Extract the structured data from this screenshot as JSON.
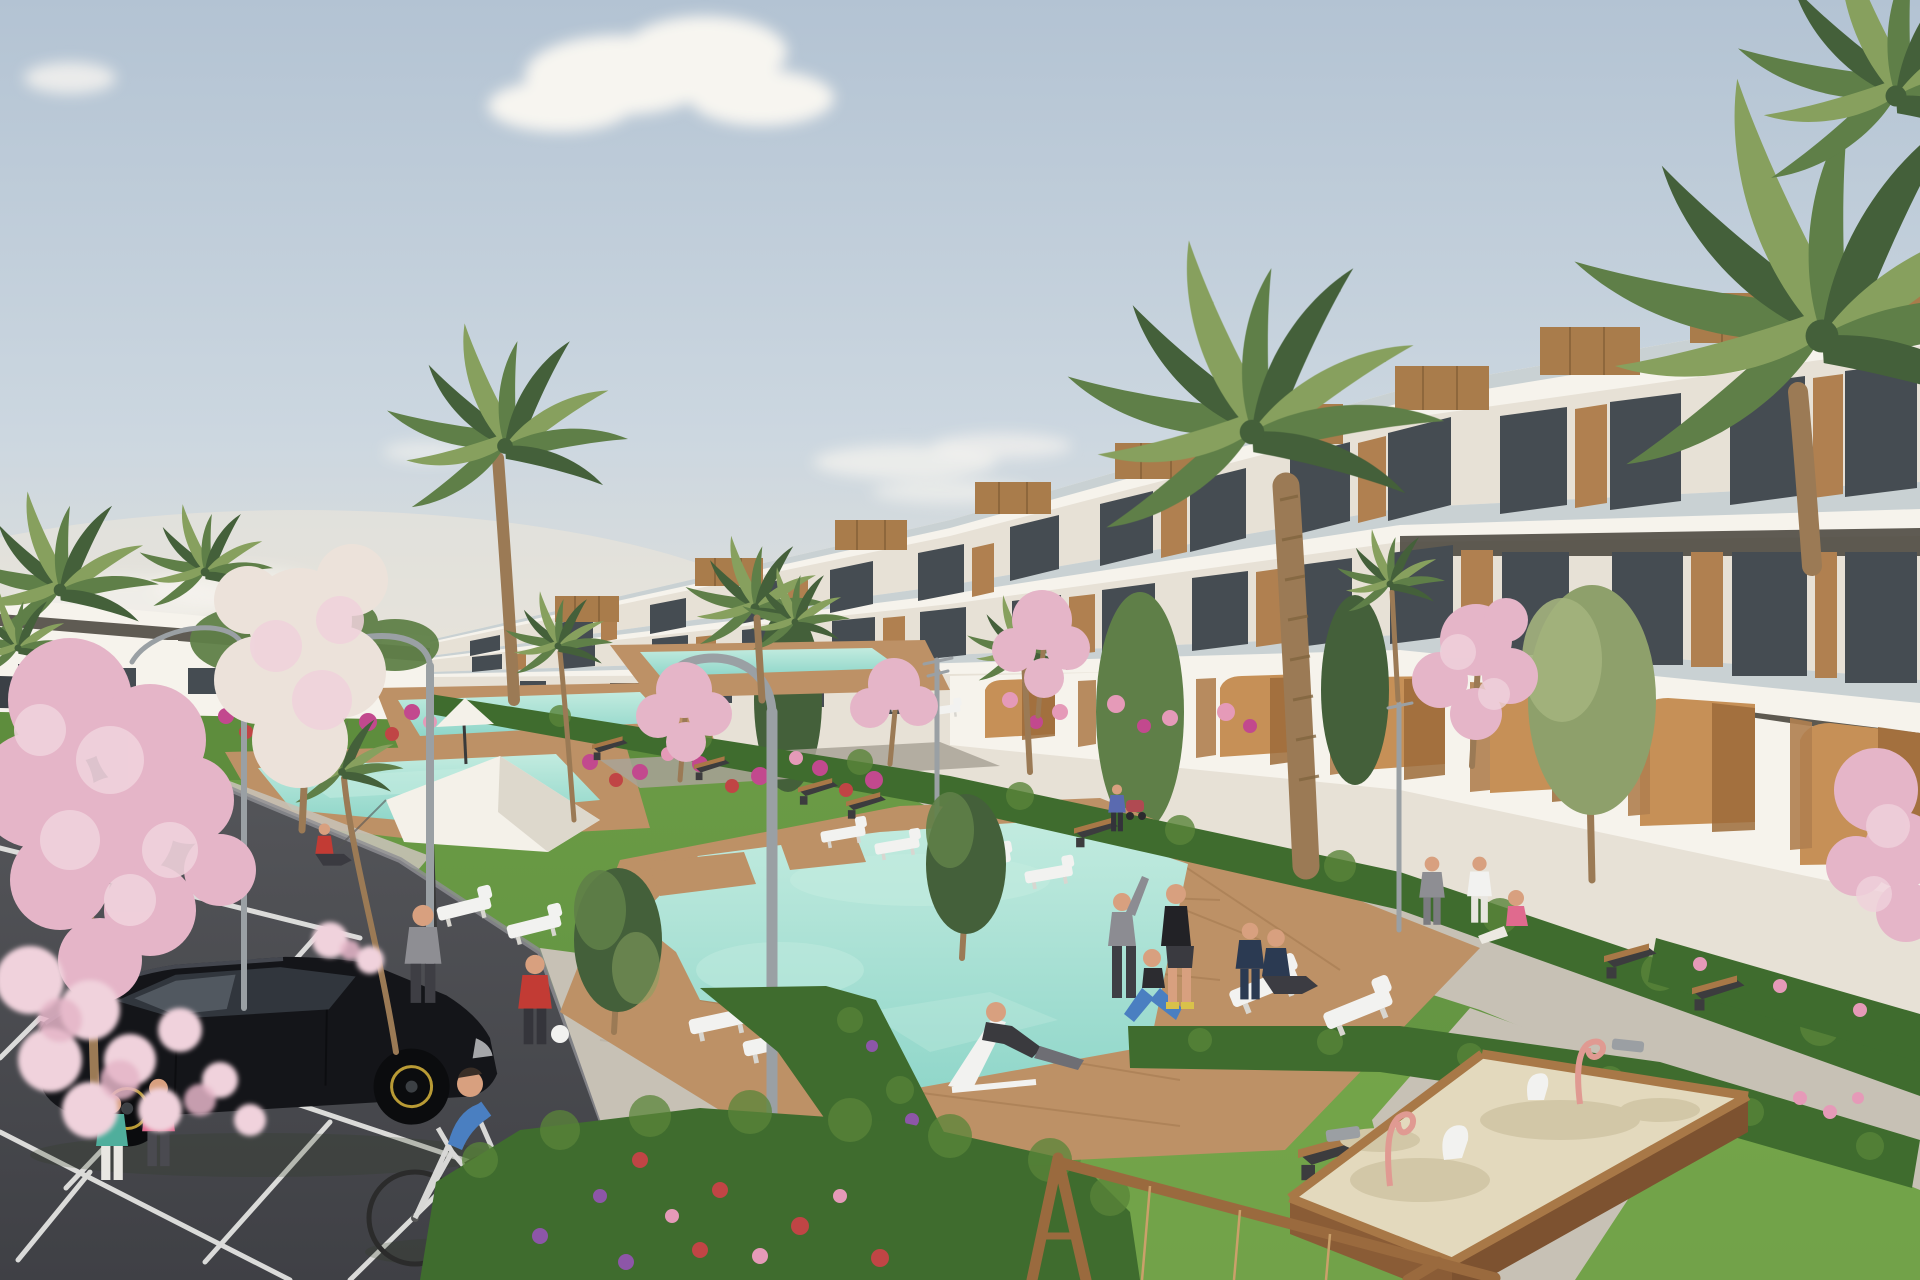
{
  "scene": {
    "description": "Photorealistic architectural rendering of a modern white terraced apartment complex with wood accents, landscaped gardens, a chain of turquoise swimming pools with wooden decks, palm and pink blossom trees, a parking lot with a black hatchback and a dark sedan, a man cycling, residents exercising and relaxing on lawns, white sun loungers and parasols, curved street lamps, dark benches, a wooden sandbox playground with pink ride-on toys and a wooden swing frame, under a pale blue sky with soft clouds.",
    "objects": {
      "apartment_building_terraced": 1,
      "distant_low_building": 1,
      "swimming_pools": 5,
      "wooden_pool_decks": 4,
      "palm_trees": 14,
      "pink_blossom_trees": 8,
      "green_trees": 7,
      "hedges": 6,
      "flower_beds": 7,
      "cars": 3,
      "bicycle_rider": 1,
      "pedestrians_and_people": 17,
      "sun_loungers": 12,
      "parasols": 2,
      "street_lamps": 5,
      "benches": 9,
      "sandbox": 1,
      "sandbox_toys": 5,
      "swing_frame": 1,
      "parking_stall_lines": 10,
      "clouds": 6
    }
  },
  "palette": {
    "sky-top": "#b3c3d3",
    "sky-mid": "#ccd7e0",
    "horizon": "#e8e3d8",
    "cloud": "#f7f5f0",
    "bld-lit": "#f6f3ec",
    "bld-wall": "#e7e1d6",
    "bld-shade": "#d9d3c7",
    "soffit": "#4a463e",
    "glass": "#454c52",
    "glass-balustrade": "#b9c6cb",
    "wood": "#b08050",
    "wood-roof": "#a97c4b",
    "wood-dark": "#8a5c36",
    "arch-wall": "#c69057",
    "arch-shade": "#9c6b3a",
    "palm-dark": "#44603a",
    "palm-mid": "#5f7f48",
    "palm-light": "#87a05e",
    "trunk": "#9b7a55",
    "grass": "#679844",
    "grass-light": "#82b050",
    "grass-dark": "#4f7c33",
    "hedge": "#3f6c2e",
    "hedge-light": "#5a8539",
    "flower-magenta": "#c2498e",
    "flower-red": "#c04545",
    "flower-pink": "#e59ab8",
    "flower-purple": "#8d56a8",
    "blossom": "#e5b5c8",
    "blossom-light": "#f0d2dc",
    "blossom-white": "#ece2da",
    "pool": "#8fd6c9",
    "pool-light": "#c2ebdf",
    "deck": "#bd9166",
    "deck-dark": "#9e744a",
    "path": "#c7c1b5",
    "path-dark": "#a9a398",
    "asphalt": "#55565a",
    "asphalt-dark": "#3f4045",
    "marking": "#e8e8e6",
    "car-black": "#141519",
    "car-glass": "#31363d",
    "sedan-blue": "#2e3a47",
    "sand": "#e3d9bd",
    "sand-shade": "#d2c7a7",
    "toy-pink": "#e09a92",
    "metal-gray": "#9b9fa3",
    "skin": "#d8a07f",
    "lamp-gray": "#9aa0a4",
    "bench-dark": "#3c3c3e",
    "wood-bench": "#a87847",
    "white": "#f2f2f0",
    "shirt-blue": "#4a7fc1",
    "teal": "#4fae9c",
    "pink": "#e06a8e",
    "red": "#c23b34",
    "navy": "#2b3a52",
    "charcoal": "#3a3a3e",
    "gray": "#8e8e93",
    "yellow": "#d9c14a",
    "rim-gold": "#b99b35"
  }
}
